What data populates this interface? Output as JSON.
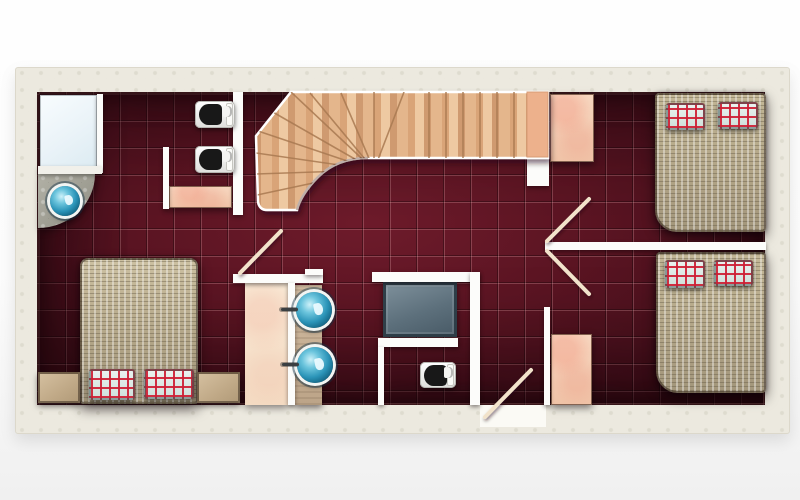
{
  "scene": {
    "kind": "residential upper-floor plan, top-down architectural rendering",
    "floor_finish": "dark red ceramic tile with grout grid",
    "wall_finish": "white walls inside a cream plaster outline",
    "no_visible_text": true
  },
  "palette": {
    "background": "#f7f7f7",
    "frame_cream": "#ece9df",
    "floor_tile": "#5a1422",
    "floor_tile_dark": "#350b14",
    "grout_line": "#e8b9bd",
    "wall_white": "#fcfcfa",
    "stair_wood_light": "#eec9a2",
    "stair_wood_dark": "#cf9a70",
    "furniture_pink": "#f2c7ab",
    "closet_cream": "#f7e7d3",
    "counter_tan": "#c9b299",
    "blanket_tan": "#b2a587",
    "pillow_base": "#e3eeea",
    "pillow_plaid_red": "#ce1e34",
    "sink_blue": "#2b94b8",
    "shower_slate": "#5d707c",
    "stone_gray": "#9d9c91",
    "toilet_seat_black": "#181818"
  },
  "labels": {
    "plan": "floor plan drawing",
    "frame": "exterior wall outline",
    "floor": "red tiled floor",
    "staircase": "curved wooden staircase",
    "stair_landing": "stair landing",
    "bed": "double bed with woven blanket",
    "pillow": "red plaid pillow",
    "nightstand": "nightstand",
    "wardrobe": "wardrobe",
    "closet": "tall closet",
    "toilet": "toilet",
    "sink": "round blue basin",
    "corner_basin": "corner stone counter with round basin",
    "shower_cabin": "shower cabin",
    "shower_tray": "slate shower tray",
    "vanity_counter": "vanity counter",
    "door": "door swing",
    "threshold": "entry door threshold",
    "wall": "interior wall"
  },
  "inventory": {
    "bedrooms": 3,
    "beds": 3,
    "pillows": 6,
    "toilets": 3,
    "round_basins": 3,
    "nightstands": 2,
    "pink_wardrobes": 4,
    "door_swings": 4,
    "staircases": 1,
    "shower_trays": 1,
    "shower_cabins": 1,
    "vanity_counters": 2
  }
}
